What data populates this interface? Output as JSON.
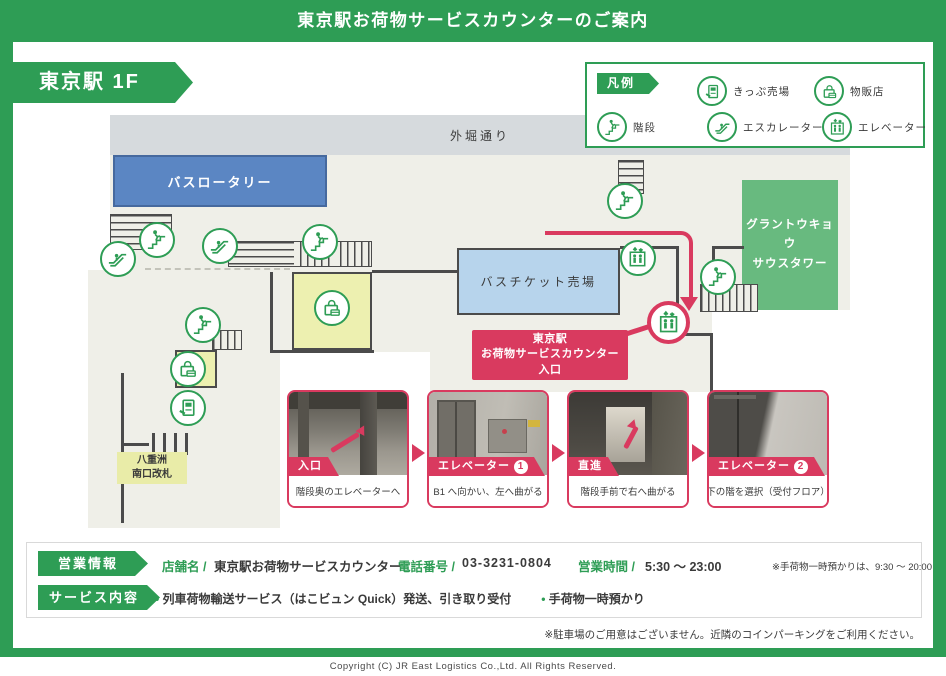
{
  "colors": {
    "green": "#2E9D55",
    "crimson": "#D93A5F",
    "bus_blue": "#5B86C3",
    "ticket_blue": "#B7D4EC",
    "tower_green": "#68BA7F",
    "shop_yellow": "#EDF0B0",
    "gate_yellow": "#E9ECA8",
    "floor": "#EFEFE8",
    "street": "#D6DADD",
    "wall": "#4B4B4B",
    "text": "#3A3A3A"
  },
  "header": {
    "title": "東京駅お荷物サービスカウンターのご案内"
  },
  "floor_label": "東京駅 1F",
  "legend": {
    "title": "凡例",
    "items": [
      {
        "icon": "ticket-machine-icon",
        "label": "きっぷ売場"
      },
      {
        "icon": "shop-bag-icon",
        "label": "物販店"
      },
      {
        "icon": "stairs-icon",
        "label": "階段"
      },
      {
        "icon": "escalator-icon",
        "label": "エスカレーター"
      },
      {
        "icon": "elevator-icon",
        "label": "エレベーター"
      }
    ]
  },
  "map": {
    "street": "外堀通り",
    "areas": {
      "bus_rotary": "バスロータリー",
      "bus_ticket": "バスチケット売場",
      "tower": "グラントウキョウ\nサウスタワー",
      "yaesu_gate": "八重洲\n南口改札"
    },
    "entrance_callout": "東京駅\nお荷物サービスカウンター\n入口"
  },
  "route_photos": [
    {
      "tag": "入口",
      "number": null,
      "caption": "階段奥のエレベーターへ"
    },
    {
      "tag": "エレベーター",
      "number": "1",
      "caption": "B1 へ向かい、左へ曲がる"
    },
    {
      "tag": "直進",
      "number": null,
      "caption": "階段手前で右へ曲がる"
    },
    {
      "tag": "エレベーター",
      "number": "2",
      "caption": "下の階を選択（受付フロア）"
    }
  ],
  "info": {
    "business_label": "営業情報",
    "shop_name_label": "店舗名 /",
    "shop_name": "東京駅お荷物サービスカウンター",
    "phone_label": "電話番号 /",
    "phone": "03-3231-0804",
    "hours_label": "営業時間 /",
    "hours": "5:30 ～ 23:00",
    "hours_note": "※手荷物一時預かりは、9:30 ～ 20:00",
    "service_label": "サービス内容",
    "services": {
      "s1": "列車荷物輸送サービス（はこビュン Quick）発送、引き取り受付",
      "s2": "手荷物一時預かり"
    },
    "parking_note": "※駐車場のご用意はございません。近隣のコインパーキングをご利用ください。"
  },
  "footer": {
    "copyright": "Copyright (C) JR East Logistics Co.,Ltd. All Rights Reserved."
  }
}
